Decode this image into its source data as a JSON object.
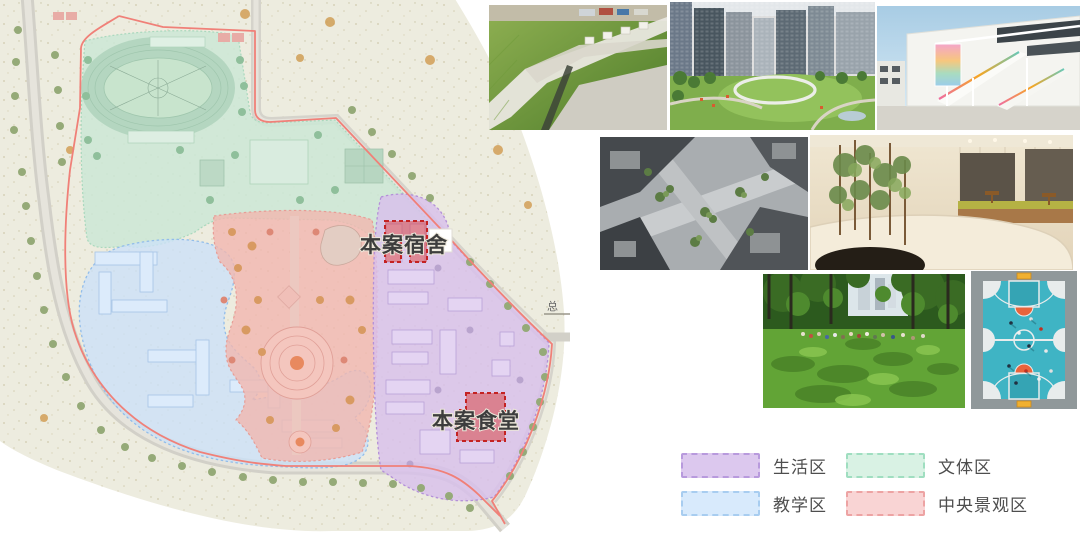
{
  "map": {
    "name": "campus-zoning-master-plan",
    "annotations": {
      "dormitory": "本案宿舍",
      "canteen": "本案食堂",
      "corner_mark": "总"
    },
    "zones": [
      {
        "id": "living",
        "label": "生活区",
        "fill": "#d8c0eb",
        "border": "#b490d8"
      },
      {
        "id": "teaching",
        "label": "教学区",
        "fill": "#cce1f8",
        "border": "#92bdea"
      },
      {
        "id": "sports-culture",
        "label": "文体区",
        "fill": "#cbe8d6",
        "border": "#a9d8bd"
      },
      {
        "id": "central-landscape",
        "label": "中央景观区",
        "fill": "#f1b6af",
        "border": "#e79d96"
      }
    ],
    "boundary_color": "#f08078",
    "highlight_color": "#c42222",
    "background_color": "#edecdf"
  },
  "legend": {
    "items": [
      {
        "label": "生活区",
        "fill": "#dcc8ee",
        "border": "#b89add"
      },
      {
        "label": "文体区",
        "fill": "#d9f2e4",
        "border": "#9fdec0"
      },
      {
        "label": "教学区",
        "fill": "#d8eafc",
        "border": "#a8cdf0"
      },
      {
        "label": "中央景观区",
        "fill": "#f9d4d4",
        "border": "#eda3a3"
      }
    ]
  },
  "photos": [
    {
      "name": "green-roof-aerial"
    },
    {
      "name": "city-park-ring"
    },
    {
      "name": "school-rainbow-stairs"
    },
    {
      "name": "courtyard-aerial"
    },
    {
      "name": "warm-interior"
    },
    {
      "name": "park-lawn"
    },
    {
      "name": "basketball-court"
    }
  ]
}
